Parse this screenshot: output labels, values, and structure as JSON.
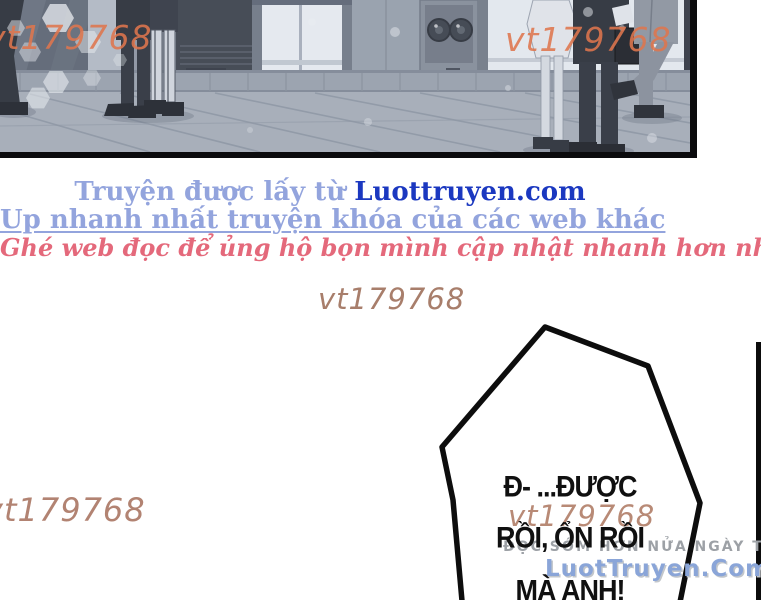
{
  "watermarks": {
    "top_left": "vt179768",
    "top_center": "vt179768",
    "middle": "vt179768",
    "bottom_left": "vt179768",
    "bubble_overlay": "vt179768"
  },
  "credits": {
    "line1_prefix": "Truyện được lấy từ ",
    "line1_site": "Luottruyen.com",
    "line2": "Up nhanh nhất truyện khóa của các web khác",
    "line3": "Ghé web đọc để ủng hộ bọn mình cập nhật nhanh hơn nhé"
  },
  "speech_bubble": {
    "line1": "Đ- ...ĐƯỢC",
    "line2": "RỒI, ỔN RỒI",
    "line3": "MÀ ANH!"
  },
  "promo": {
    "tagline": "ĐỌC SỚM HƠN NỬA NGÀY TẠI",
    "site": "LuotTruyen.Com"
  },
  "colors": {
    "watermark_orange": "#df764e",
    "watermark_brown": "#a87e6b",
    "credit_light_blue": "#93a4dd",
    "credit_dark_blue": "#1b38c0",
    "credit_pink": "#e4697b",
    "promo_gray": "#9da1a6",
    "promo_blue": "#8aa5d8",
    "panel_border": "#0b0b0d"
  }
}
